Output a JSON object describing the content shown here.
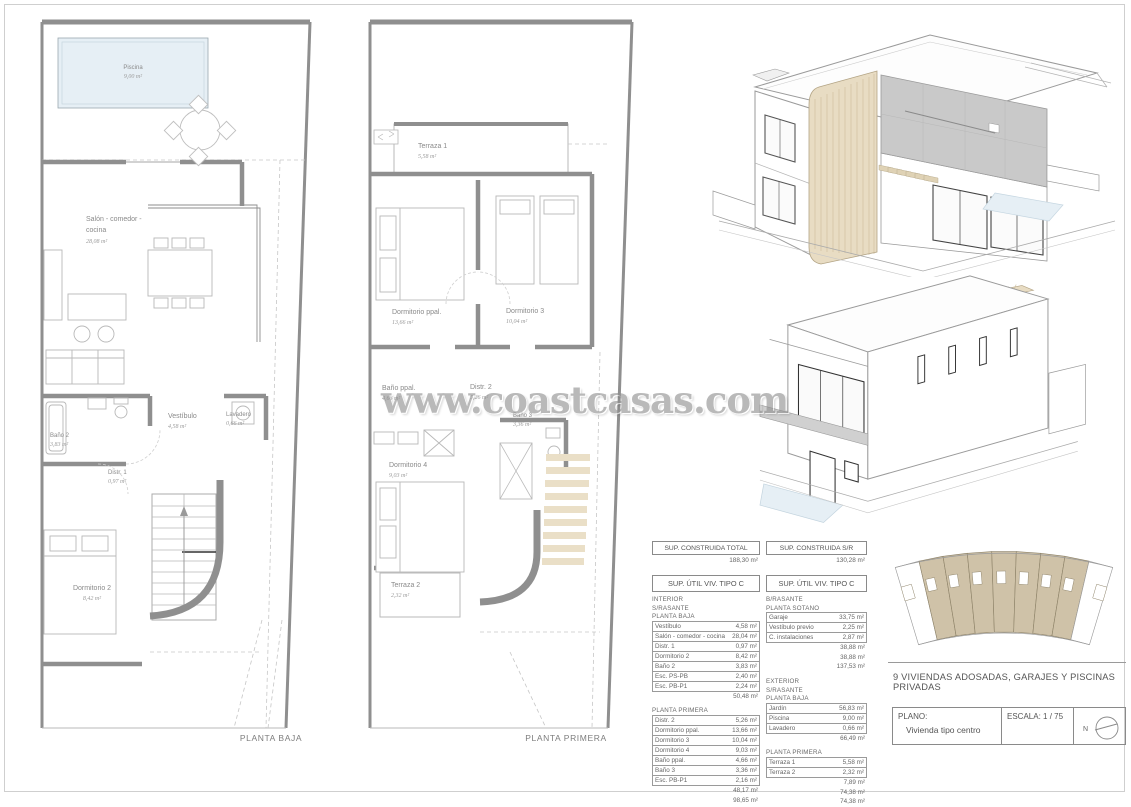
{
  "watermark": "www.coastcasas.com",
  "colors": {
    "wall": "#8f8f8f",
    "line": "#b8b8b8",
    "pool": "#e6eff5",
    "wood": "#e8dcc3",
    "woodline": "#b3a485",
    "panel": "#c9c9c9",
    "tread": "#eadfc7",
    "siteunit": "#cfc2a8",
    "ink": "#8a8a8a"
  },
  "planta_baja": {
    "caption": "PLANTA BAJA",
    "rooms": {
      "piscina": {
        "name": "Piscina",
        "area": "9,00 m²"
      },
      "salon": {
        "name": "Salón - comedor -",
        "name2": "cocina",
        "area": "28,08 m²"
      },
      "bano2": {
        "name": "Baño 2",
        "area": "3,83 m²"
      },
      "vestibulo": {
        "name": "Vestíbulo",
        "area": "4,58 m²"
      },
      "lavadero": {
        "name": "Lavadero",
        "area": "0,66 m²"
      },
      "distr1": {
        "name": "Distr. 1",
        "area": "0,97 m²"
      },
      "dormitorio2": {
        "name": "Dormitorio 2",
        "area": "8,42 m²"
      }
    }
  },
  "planta_primera": {
    "caption": "PLANTA PRIMERA",
    "rooms": {
      "terraza1": {
        "name": "Terraza 1",
        "area": "5,58 m²"
      },
      "dormppal": {
        "name": "Dormitorio ppal.",
        "area": "13,66 m²"
      },
      "dorm3": {
        "name": "Dormitorio 3",
        "area": "10,04 m²"
      },
      "banoppal": {
        "name": "Baño ppal.",
        "area": "4,66 m²"
      },
      "distr2": {
        "name": "Distr. 2",
        "area": "5,26 m²"
      },
      "bano3": {
        "name": "Baño 3",
        "area": "3,36 m²"
      },
      "dorm4": {
        "name": "Dormitorio 4",
        "area": "9,03 m²"
      },
      "terraza2": {
        "name": "Terraza 2",
        "area": "2,32 m²"
      }
    }
  },
  "sup_construida": {
    "left": {
      "label": "SUP. CONSTRUIDA TOTAL",
      "value": "188,30 m²"
    },
    "right": {
      "label": "SUP. CONSTRUIDA S/R",
      "value": "130,28 m²"
    }
  },
  "util_left": {
    "header": "SUP. ÚTIL VIV. TIPO C",
    "rows": [
      {
        "t": "sec",
        "n": "INTERIOR"
      },
      {
        "t": "sec",
        "n": "S/RASANTE"
      },
      {
        "t": "sec",
        "n": "PLANTA BAJA"
      },
      {
        "t": "item",
        "n": "Vestíbulo",
        "v": "4,58 m²"
      },
      {
        "t": "item",
        "n": "Salón - comedor - cocina",
        "v": "28,04 m²"
      },
      {
        "t": "item",
        "n": "Distr. 1",
        "v": "0,97 m²"
      },
      {
        "t": "item",
        "n": "Dormitorio 2",
        "v": "8,42 m²"
      },
      {
        "t": "item",
        "n": "Baño 2",
        "v": "3,83 m²"
      },
      {
        "t": "item",
        "n": "Esc. PS-PB",
        "v": "2,40 m²"
      },
      {
        "t": "item",
        "n": "Esc. PB-P1",
        "v": "2,24 m²"
      },
      {
        "t": "sum",
        "v": "50,48 m²"
      },
      {
        "t": "sec",
        "n": "PLANTA PRIMERA"
      },
      {
        "t": "item",
        "n": "Distr. 2",
        "v": "5,26 m²"
      },
      {
        "t": "item",
        "n": "Dormitorio ppal.",
        "v": "13,66 m²"
      },
      {
        "t": "item",
        "n": "Dormitorio 3",
        "v": "10,04 m²"
      },
      {
        "t": "item",
        "n": "Dormitorio 4",
        "v": "9,03 m²"
      },
      {
        "t": "item",
        "n": "Baño ppal.",
        "v": "4,66 m²"
      },
      {
        "t": "item",
        "n": "Baño 3",
        "v": "3,36 m²"
      },
      {
        "t": "item",
        "n": "Esc. PB-P1",
        "v": "2,16 m²"
      },
      {
        "t": "sum",
        "v": "48,17 m²"
      },
      {
        "t": "sum",
        "v": "98,65 m²"
      }
    ]
  },
  "util_right": {
    "header": "SUP. ÚTIL VIV. TIPO C",
    "rows": [
      {
        "t": "sec",
        "n": "B/RASANTE"
      },
      {
        "t": "sec",
        "n": "PLANTA SOTANO"
      },
      {
        "t": "item",
        "n": "Garaje",
        "v": "33,75 m²"
      },
      {
        "t": "item",
        "n": "Vestíbulo previo",
        "v": "2,25 m²"
      },
      {
        "t": "item",
        "n": "C. instalaciones",
        "v": "2,87 m²"
      },
      {
        "t": "sum",
        "v": "38,88 m²"
      },
      {
        "t": "sum",
        "v": "38,88 m²"
      },
      {
        "t": "sum",
        "v": "137,53 m²"
      },
      {
        "t": "sec",
        "n": "EXTERIOR"
      },
      {
        "t": "sec",
        "n": "S/RASANTE"
      },
      {
        "t": "sec",
        "n": "PLANTA BAJA"
      },
      {
        "t": "item",
        "n": "Jardín",
        "v": "56,83 m²"
      },
      {
        "t": "item",
        "n": "Piscina",
        "v": "9,00 m²"
      },
      {
        "t": "item",
        "n": "Lavadero",
        "v": "0,66 m²"
      },
      {
        "t": "sum",
        "v": "66,49 m²"
      },
      {
        "t": "sec",
        "n": "PLANTA PRIMERA"
      },
      {
        "t": "item",
        "n": "Terraza 1",
        "v": "5,58 m²"
      },
      {
        "t": "item",
        "n": "Terraza 2",
        "v": "2,32 m²"
      },
      {
        "t": "sum",
        "v": "7,89 m²"
      },
      {
        "t": "sum",
        "v": "74,38 m²"
      },
      {
        "t": "sum",
        "v": "74,38 m²"
      }
    ]
  },
  "titleblock": {
    "project": "9 VIVIENDAS ADOSADAS, GARAJES Y PISCINAS PRIVADAS",
    "plano_label": "PLANO:",
    "plano_value": "Vivienda tipo centro",
    "escala_label": "ESCALA:",
    "escala_value": "1 / 75",
    "north": "N"
  }
}
